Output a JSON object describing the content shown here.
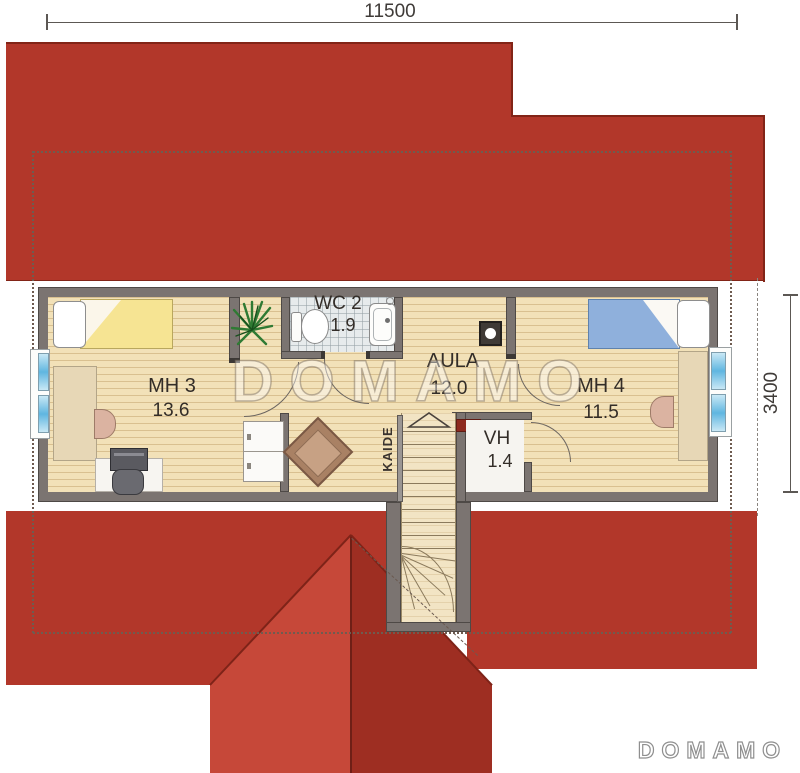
{
  "dimensions": {
    "width_top": "11500",
    "height_right": "3400"
  },
  "rooms": {
    "mh3": {
      "name": "MH 3",
      "area": "13.6"
    },
    "wc2": {
      "name": "WC 2",
      "area": "1.9"
    },
    "aula": {
      "name": "AULA",
      "area": "12.0"
    },
    "vh": {
      "name": "VH",
      "area": "1.4"
    },
    "mh4": {
      "name": "MH 4",
      "area": "11.5"
    }
  },
  "stairs": {
    "railing_label": "KAIDE"
  },
  "branding": {
    "watermark": "DOMAMO",
    "logo": "DOMAMO"
  },
  "colors": {
    "roof": "#b2372a",
    "roof_gable_light": "#c64839",
    "roof_gable_dark": "#9e2e22",
    "wall": "#7b7471",
    "wood_floor": "#f2e1b8",
    "tile_floor": "#e7ebec",
    "bed_yellow": "#f6e493",
    "bed_blue": "#8fb0dc",
    "window_glass": "#5fb6e0"
  }
}
